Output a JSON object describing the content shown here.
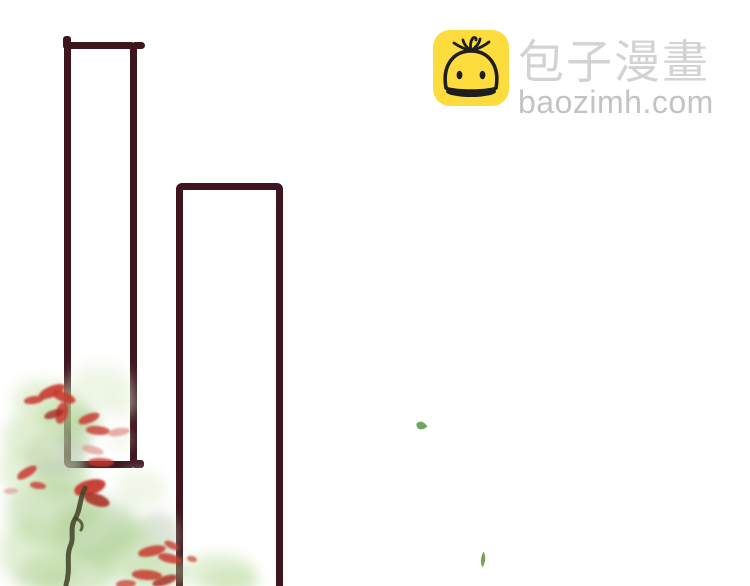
{
  "watermark": {
    "site_name": "包子漫畫",
    "domain": "baozimh.com"
  },
  "icons": {
    "logo": "baozi-steamed-bun-face"
  },
  "colors": {
    "frame": "#3e1620",
    "brand_yellow": "#ffdc3e",
    "bun_outline": "#1e1e1e",
    "title_gray": "#d3d3d3",
    "domain_gray": "#c3c3c3",
    "g_pale": "#e3f0d6",
    "g_light": "#cde4b6",
    "g_mid": "#abcf8d",
    "g_deep": "#92bd72",
    "g_gray": "#b5c6ac",
    "red": "#c83a30",
    "red_dark": "#a8281f",
    "red_pale": "#e0958d",
    "branch": "#44452a",
    "leaf": "#5f9c4a"
  },
  "foliage": {
    "blobs": [
      [
        14,
        380,
        62,
        44,
        "g_light",
        0.55,
        7
      ],
      [
        38,
        396,
        56,
        38,
        "g_mid",
        0.5,
        6
      ],
      [
        4,
        414,
        56,
        50,
        "g_light",
        0.6,
        7
      ],
      [
        26,
        432,
        60,
        44,
        "g_gray",
        0.5,
        5
      ],
      [
        0,
        448,
        52,
        46,
        "g_light",
        0.5,
        7
      ],
      [
        34,
        456,
        56,
        42,
        "g_mid",
        0.45,
        6
      ],
      [
        70,
        366,
        62,
        40,
        "g_pale",
        0.6,
        8
      ],
      [
        100,
        390,
        38,
        28,
        "g_pale",
        0.45,
        7
      ],
      [
        60,
        410,
        40,
        26,
        "g_mid",
        0.45,
        6
      ],
      [
        8,
        478,
        92,
        66,
        "g_mid",
        0.5,
        8
      ],
      [
        54,
        500,
        88,
        62,
        "g_deep",
        0.45,
        8
      ],
      [
        0,
        522,
        66,
        62,
        "g_light",
        0.6,
        8
      ],
      [
        30,
        546,
        88,
        50,
        "g_mid",
        0.5,
        8
      ],
      [
        96,
        524,
        66,
        56,
        "g_light",
        0.55,
        8
      ],
      [
        116,
        470,
        50,
        38,
        "g_pale",
        0.55,
        7
      ],
      [
        138,
        512,
        42,
        46,
        "g_gray",
        0.45,
        6
      ],
      [
        124,
        552,
        62,
        38,
        "g_mid",
        0.5,
        7
      ],
      [
        186,
        554,
        70,
        38,
        "g_light",
        0.6,
        7
      ],
      [
        208,
        568,
        50,
        24,
        "g_mid",
        0.4,
        6
      ],
      [
        56,
        428,
        36,
        26,
        "g_deep",
        0.35,
        5
      ],
      [
        16,
        560,
        58,
        28,
        "g_deep",
        0.4,
        7
      ],
      [
        106,
        430,
        26,
        20,
        "g_pale",
        0.4,
        6
      ]
    ],
    "petals": [
      [
        38,
        386,
        28,
        11,
        -20,
        "red",
        0.9
      ],
      [
        24,
        396,
        20,
        8,
        -5,
        "red",
        0.85
      ],
      [
        52,
        392,
        24,
        10,
        25,
        "red",
        0.9
      ],
      [
        56,
        402,
        12,
        22,
        10,
        "red",
        0.85
      ],
      [
        44,
        410,
        20,
        8,
        -15,
        "red_dark",
        0.8
      ],
      [
        78,
        414,
        22,
        9,
        -18,
        "red",
        0.85
      ],
      [
        86,
        426,
        24,
        9,
        8,
        "red",
        0.8
      ],
      [
        108,
        428,
        22,
        8,
        -6,
        "red_pale",
        0.75
      ],
      [
        82,
        446,
        22,
        8,
        18,
        "red_pale",
        0.7
      ],
      [
        88,
        458,
        26,
        9,
        4,
        "red",
        0.8
      ],
      [
        16,
        468,
        22,
        9,
        -28,
        "red",
        0.85
      ],
      [
        30,
        482,
        16,
        7,
        12,
        "red",
        0.8
      ],
      [
        74,
        480,
        32,
        15,
        -12,
        "red",
        0.95
      ],
      [
        84,
        494,
        26,
        12,
        22,
        "red_dark",
        0.85
      ],
      [
        4,
        488,
        14,
        6,
        0,
        "red_pale",
        0.6
      ],
      [
        138,
        546,
        28,
        10,
        -10,
        "red",
        0.85
      ],
      [
        158,
        554,
        24,
        9,
        16,
        "red",
        0.85
      ],
      [
        187,
        556,
        10,
        6,
        20,
        "red",
        0.7
      ],
      [
        132,
        570,
        30,
        10,
        6,
        "red",
        0.85
      ],
      [
        152,
        576,
        26,
        9,
        -16,
        "red_dark",
        0.8
      ],
      [
        164,
        542,
        16,
        7,
        30,
        "red",
        0.8
      ],
      [
        116,
        580,
        20,
        8,
        0,
        "red",
        0.75
      ]
    ]
  }
}
